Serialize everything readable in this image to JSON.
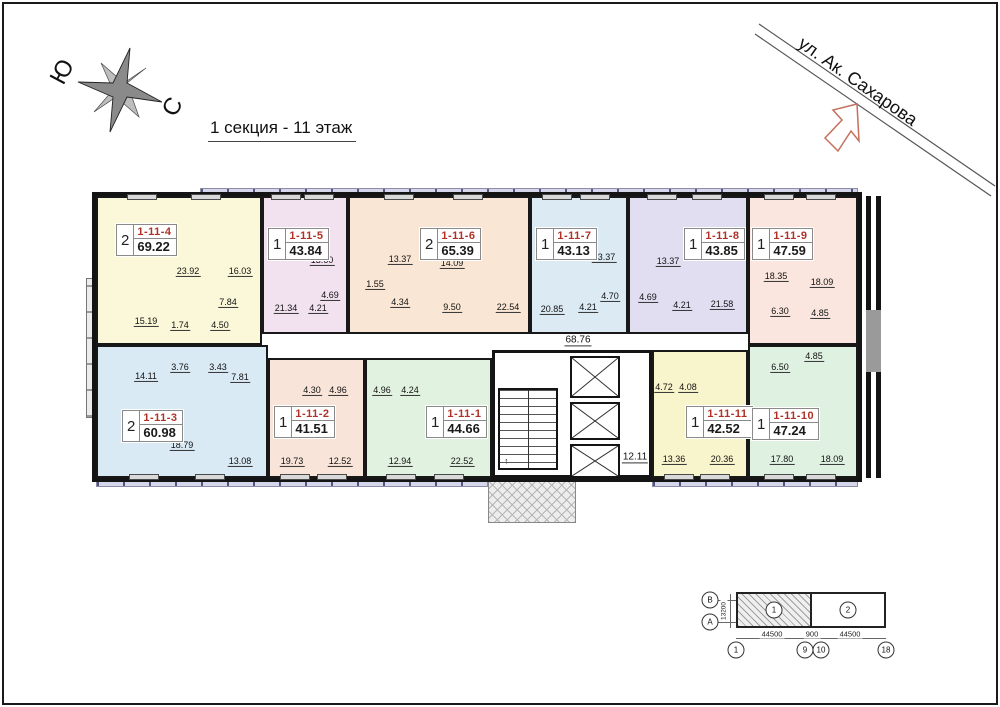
{
  "title": "1 секция - 11 этаж",
  "compass": {
    "south": "Ю",
    "north": "С"
  },
  "street": {
    "name": "ул. Ак. Сахарова"
  },
  "corridor": {
    "hall_area": "68.76",
    "lobby_area": "12.11"
  },
  "apartments": [
    {
      "id": "1-11-4",
      "rooms": "2",
      "total_area": "69.22",
      "color": "#faf8d8",
      "exterior": "top",
      "rect": {
        "x": 96,
        "y": 196,
        "w": 166,
        "h": 149
      },
      "label": {
        "x": 116,
        "y": 224
      },
      "room_areas": [
        {
          "v": "23.92",
          "x": 188,
          "y": 272
        },
        {
          "v": "16.03",
          "x": 240,
          "y": 272
        },
        {
          "v": "7.84",
          "x": 228,
          "y": 303
        },
        {
          "v": "15.19",
          "x": 146,
          "y": 322
        },
        {
          "v": "1.74",
          "x": 180,
          "y": 326
        },
        {
          "v": "4.50",
          "x": 220,
          "y": 326
        }
      ]
    },
    {
      "id": "1-11-5",
      "rooms": "1",
      "total_area": "43.84",
      "color": "#f2e2f0",
      "exterior": "top",
      "rect": {
        "x": 262,
        "y": 196,
        "w": 86,
        "h": 138
      },
      "label": {
        "x": 268,
        "y": 228
      },
      "room_areas": [
        {
          "v": "13.60",
          "x": 322,
          "y": 261
        },
        {
          "v": "21.34",
          "x": 286,
          "y": 309
        },
        {
          "v": "4.21",
          "x": 318,
          "y": 309
        },
        {
          "v": "4.69",
          "x": 330,
          "y": 296
        }
      ]
    },
    {
      "id": "1-11-6",
      "rooms": "2",
      "total_area": "65.39",
      "color": "#fae6d4",
      "exterior": "top",
      "rect": {
        "x": 348,
        "y": 196,
        "w": 182,
        "h": 138
      },
      "label": {
        "x": 420,
        "y": 228
      },
      "room_areas": [
        {
          "v": "13.37",
          "x": 400,
          "y": 260
        },
        {
          "v": "14.09",
          "x": 452,
          "y": 264
        },
        {
          "v": "1.55",
          "x": 375,
          "y": 285
        },
        {
          "v": "4.34",
          "x": 400,
          "y": 303
        },
        {
          "v": "9.50",
          "x": 452,
          "y": 308
        },
        {
          "v": "22.54",
          "x": 508,
          "y": 308
        }
      ]
    },
    {
      "id": "1-11-7",
      "rooms": "1",
      "total_area": "43.13",
      "color": "#dceaf4",
      "exterior": "top",
      "rect": {
        "x": 530,
        "y": 196,
        "w": 98,
        "h": 138
      },
      "label": {
        "x": 536,
        "y": 228
      },
      "room_areas": [
        {
          "v": "13.37",
          "x": 604,
          "y": 258
        },
        {
          "v": "20.85",
          "x": 552,
          "y": 310
        },
        {
          "v": "4.21",
          "x": 588,
          "y": 308
        },
        {
          "v": "4.70",
          "x": 610,
          "y": 297
        }
      ]
    },
    {
      "id": "1-11-8",
      "rooms": "1",
      "total_area": "43.85",
      "color": "#e2def2",
      "exterior": "top",
      "rect": {
        "x": 628,
        "y": 196,
        "w": 120,
        "h": 138
      },
      "label": {
        "x": 684,
        "y": 228
      },
      "room_areas": [
        {
          "v": "13.37",
          "x": 668,
          "y": 262
        },
        {
          "v": "4.69",
          "x": 648,
          "y": 298
        },
        {
          "v": "4.21",
          "x": 682,
          "y": 306
        },
        {
          "v": "21.58",
          "x": 722,
          "y": 305
        }
      ]
    },
    {
      "id": "1-11-9",
      "rooms": "1",
      "total_area": "47.59",
      "color": "#fae6de",
      "exterior": "top",
      "rect": {
        "x": 748,
        "y": 196,
        "w": 110,
        "h": 149
      },
      "label": {
        "x": 752,
        "y": 228
      },
      "room_areas": [
        {
          "v": "18.35",
          "x": 776,
          "y": 277
        },
        {
          "v": "18.09",
          "x": 822,
          "y": 283
        },
        {
          "v": "6.30",
          "x": 780,
          "y": 312
        },
        {
          "v": "4.85",
          "x": 820,
          "y": 314
        }
      ]
    },
    {
      "id": "1-11-3",
      "rooms": "2",
      "total_area": "60.98",
      "color": "#daeaf5",
      "exterior": "bottom",
      "rect": {
        "x": 96,
        "y": 345,
        "w": 172,
        "h": 133
      },
      "label": {
        "x": 122,
        "y": 410
      },
      "room_areas": [
        {
          "v": "3.76",
          "x": 180,
          "y": 368
        },
        {
          "v": "3.43",
          "x": 218,
          "y": 368
        },
        {
          "v": "14.11",
          "x": 146,
          "y": 377
        },
        {
          "v": "7.81",
          "x": 240,
          "y": 378
        },
        {
          "v": "18.79",
          "x": 182,
          "y": 446
        },
        {
          "v": "13.08",
          "x": 240,
          "y": 462
        }
      ]
    },
    {
      "id": "1-11-2",
      "rooms": "1",
      "total_area": "41.51",
      "color": "#f8e4d8",
      "exterior": "bottom",
      "rect": {
        "x": 268,
        "y": 358,
        "w": 97,
        "h": 120
      },
      "label": {
        "x": 274,
        "y": 406
      },
      "room_areas": [
        {
          "v": "4.30",
          "x": 312,
          "y": 391
        },
        {
          "v": "4.96",
          "x": 338,
          "y": 391
        },
        {
          "v": "19.73",
          "x": 292,
          "y": 462
        },
        {
          "v": "12.52",
          "x": 340,
          "y": 462
        }
      ]
    },
    {
      "id": "1-11-1",
      "rooms": "1",
      "total_area": "44.66",
      "color": "#e2f2e0",
      "exterior": "bottom",
      "rect": {
        "x": 365,
        "y": 358,
        "w": 127,
        "h": 120
      },
      "label": {
        "x": 426,
        "y": 406
      },
      "room_areas": [
        {
          "v": "4.96",
          "x": 382,
          "y": 391
        },
        {
          "v": "4.24",
          "x": 410,
          "y": 391
        },
        {
          "v": "12.94",
          "x": 400,
          "y": 462
        },
        {
          "v": "22.52",
          "x": 462,
          "y": 462
        }
      ]
    },
    {
      "id": "1-11-11",
      "rooms": "1",
      "total_area": "42.52",
      "color": "#f8f4cc",
      "exterior": "bottom",
      "rect": {
        "x": 652,
        "y": 350,
        "w": 96,
        "h": 128
      },
      "label": {
        "x": 686,
        "y": 406
      },
      "room_areas": [
        {
          "v": "4.72",
          "x": 664,
          "y": 388
        },
        {
          "v": "4.08",
          "x": 688,
          "y": 388
        },
        {
          "v": "13.36",
          "x": 674,
          "y": 460
        },
        {
          "v": "20.36",
          "x": 722,
          "y": 460
        }
      ]
    },
    {
      "id": "1-11-10",
      "rooms": "1",
      "total_area": "47.24",
      "color": "#dff2e2",
      "exterior": "bottom",
      "rect": {
        "x": 748,
        "y": 345,
        "w": 110,
        "h": 133
      },
      "label": {
        "x": 752,
        "y": 408
      },
      "room_areas": [
        {
          "v": "4.85",
          "x": 814,
          "y": 357
        },
        {
          "v": "6.50",
          "x": 780,
          "y": 368
        },
        {
          "v": "17.80",
          "x": 782,
          "y": 460
        },
        {
          "v": "18.09",
          "x": 832,
          "y": 460
        }
      ]
    }
  ],
  "keyplan": {
    "row_axes": [
      "В",
      "А"
    ],
    "col_axes": [
      "1",
      "9",
      "10",
      "18"
    ],
    "sections": [
      {
        "label": "1"
      },
      {
        "label": "2"
      }
    ],
    "dims": {
      "left": "44500",
      "mid": "900",
      "right": "44500",
      "height": "13200"
    }
  }
}
